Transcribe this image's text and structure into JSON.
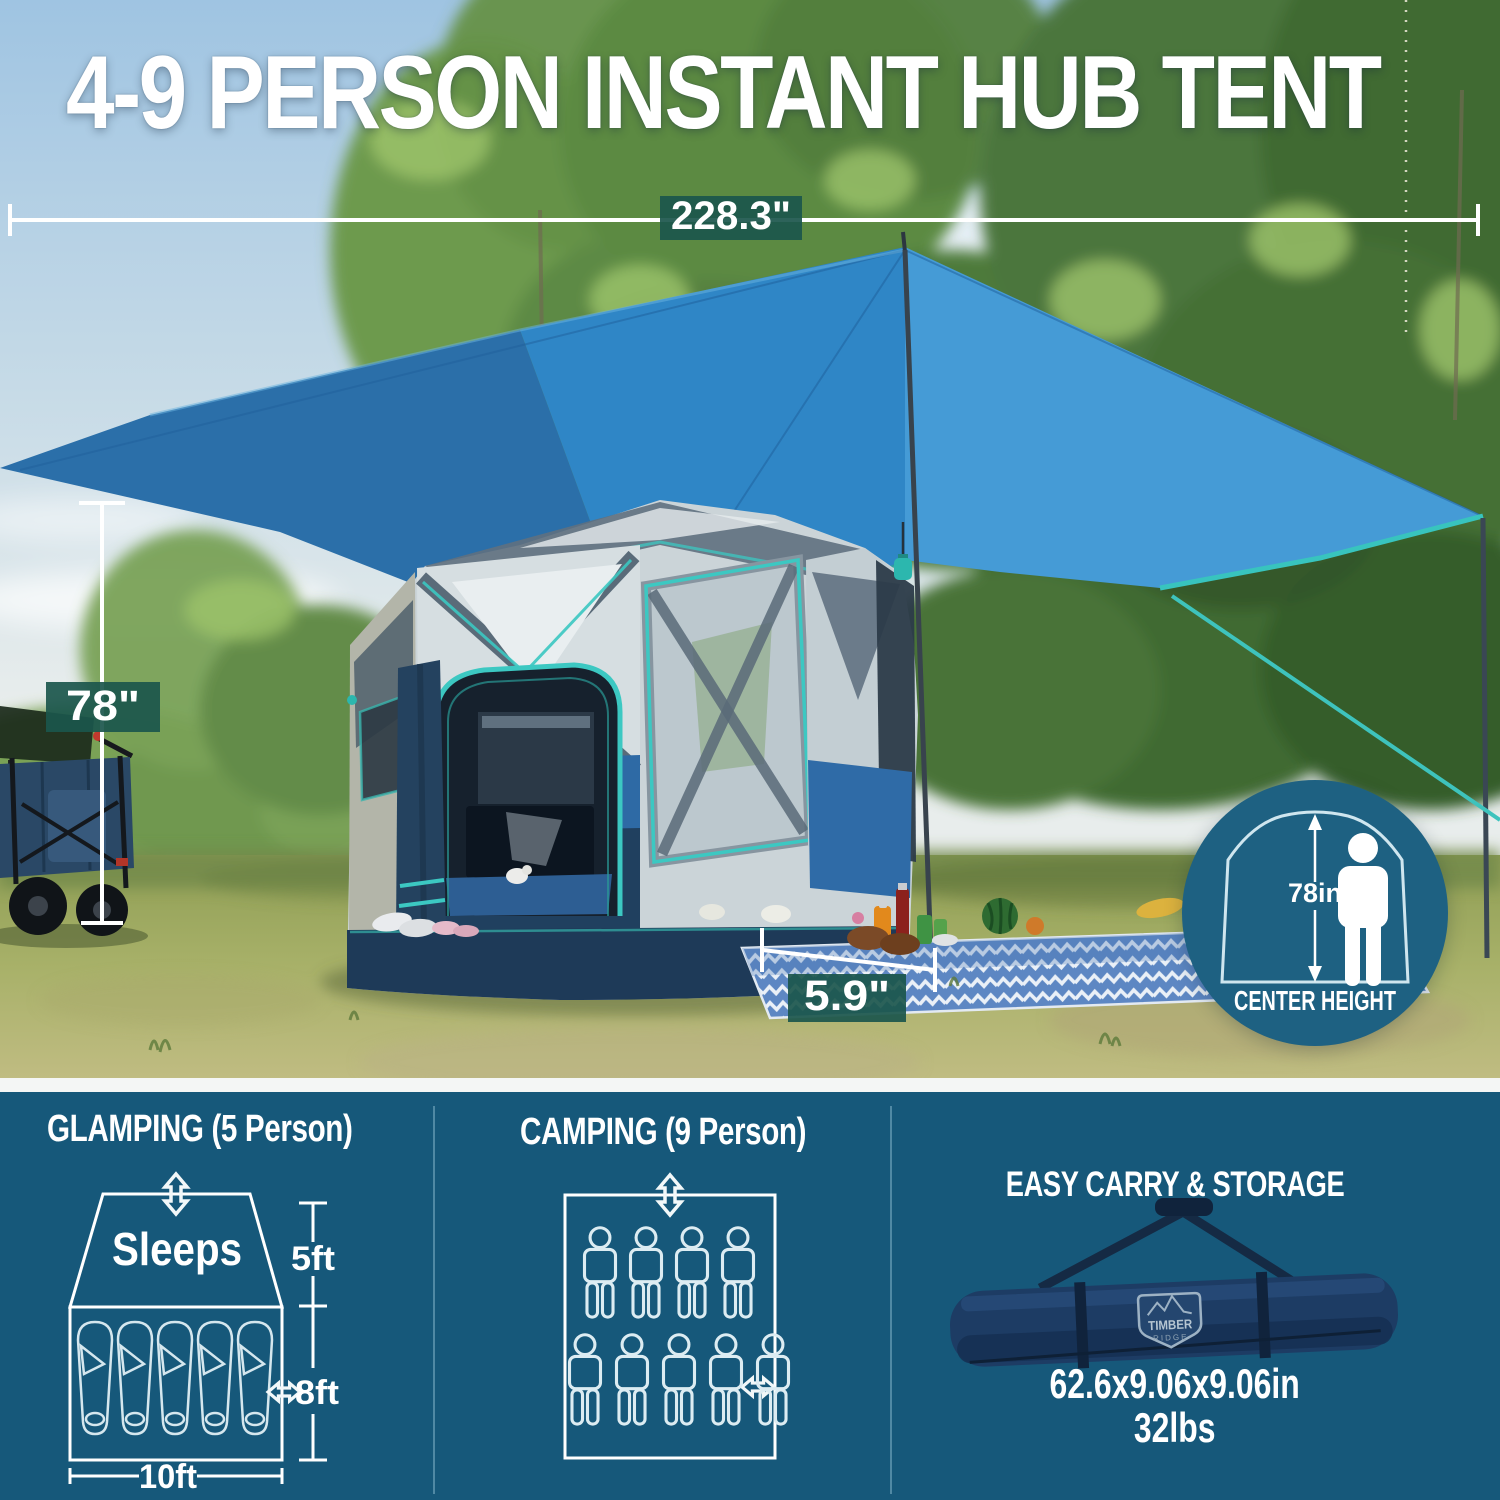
{
  "title": "4-9 PERSON INSTANT HUB TENT",
  "photo_annotations": {
    "tarp_width_label": "228.3\"",
    "tent_height_label": "78\"",
    "stake_out_label": "5.9\""
  },
  "badge": {
    "height_value": "78in",
    "caption": "CENTER HEIGHT"
  },
  "glamping": {
    "heading": "GLAMPING (5 Person)",
    "sleeps_label": "Sleeps",
    "height_label": "5ft",
    "width_label": "8ft",
    "length_label": "10ft",
    "sleeping_bag_count": 5
  },
  "camping": {
    "heading": "CAMPING (9 Person)",
    "person_count": 9,
    "top_row_count": 4,
    "bottom_row_count": 5
  },
  "storage": {
    "heading": "EASY CARRY & STORAGE",
    "logo_line1": "TIMBER",
    "logo_line2": "RIDGE",
    "size": "62.6x9.06x9.06in",
    "weight": "32lbs"
  },
  "colors": {
    "panel_teal": "#16587a",
    "badge_circle": "#1e6182",
    "label_box": "#1b564c",
    "accent_teal": "#3cc8c2",
    "tarp_blue": "#2f86c6",
    "tent_navy": "#1e3a58",
    "tent_blue": "#2e6aa5"
  }
}
